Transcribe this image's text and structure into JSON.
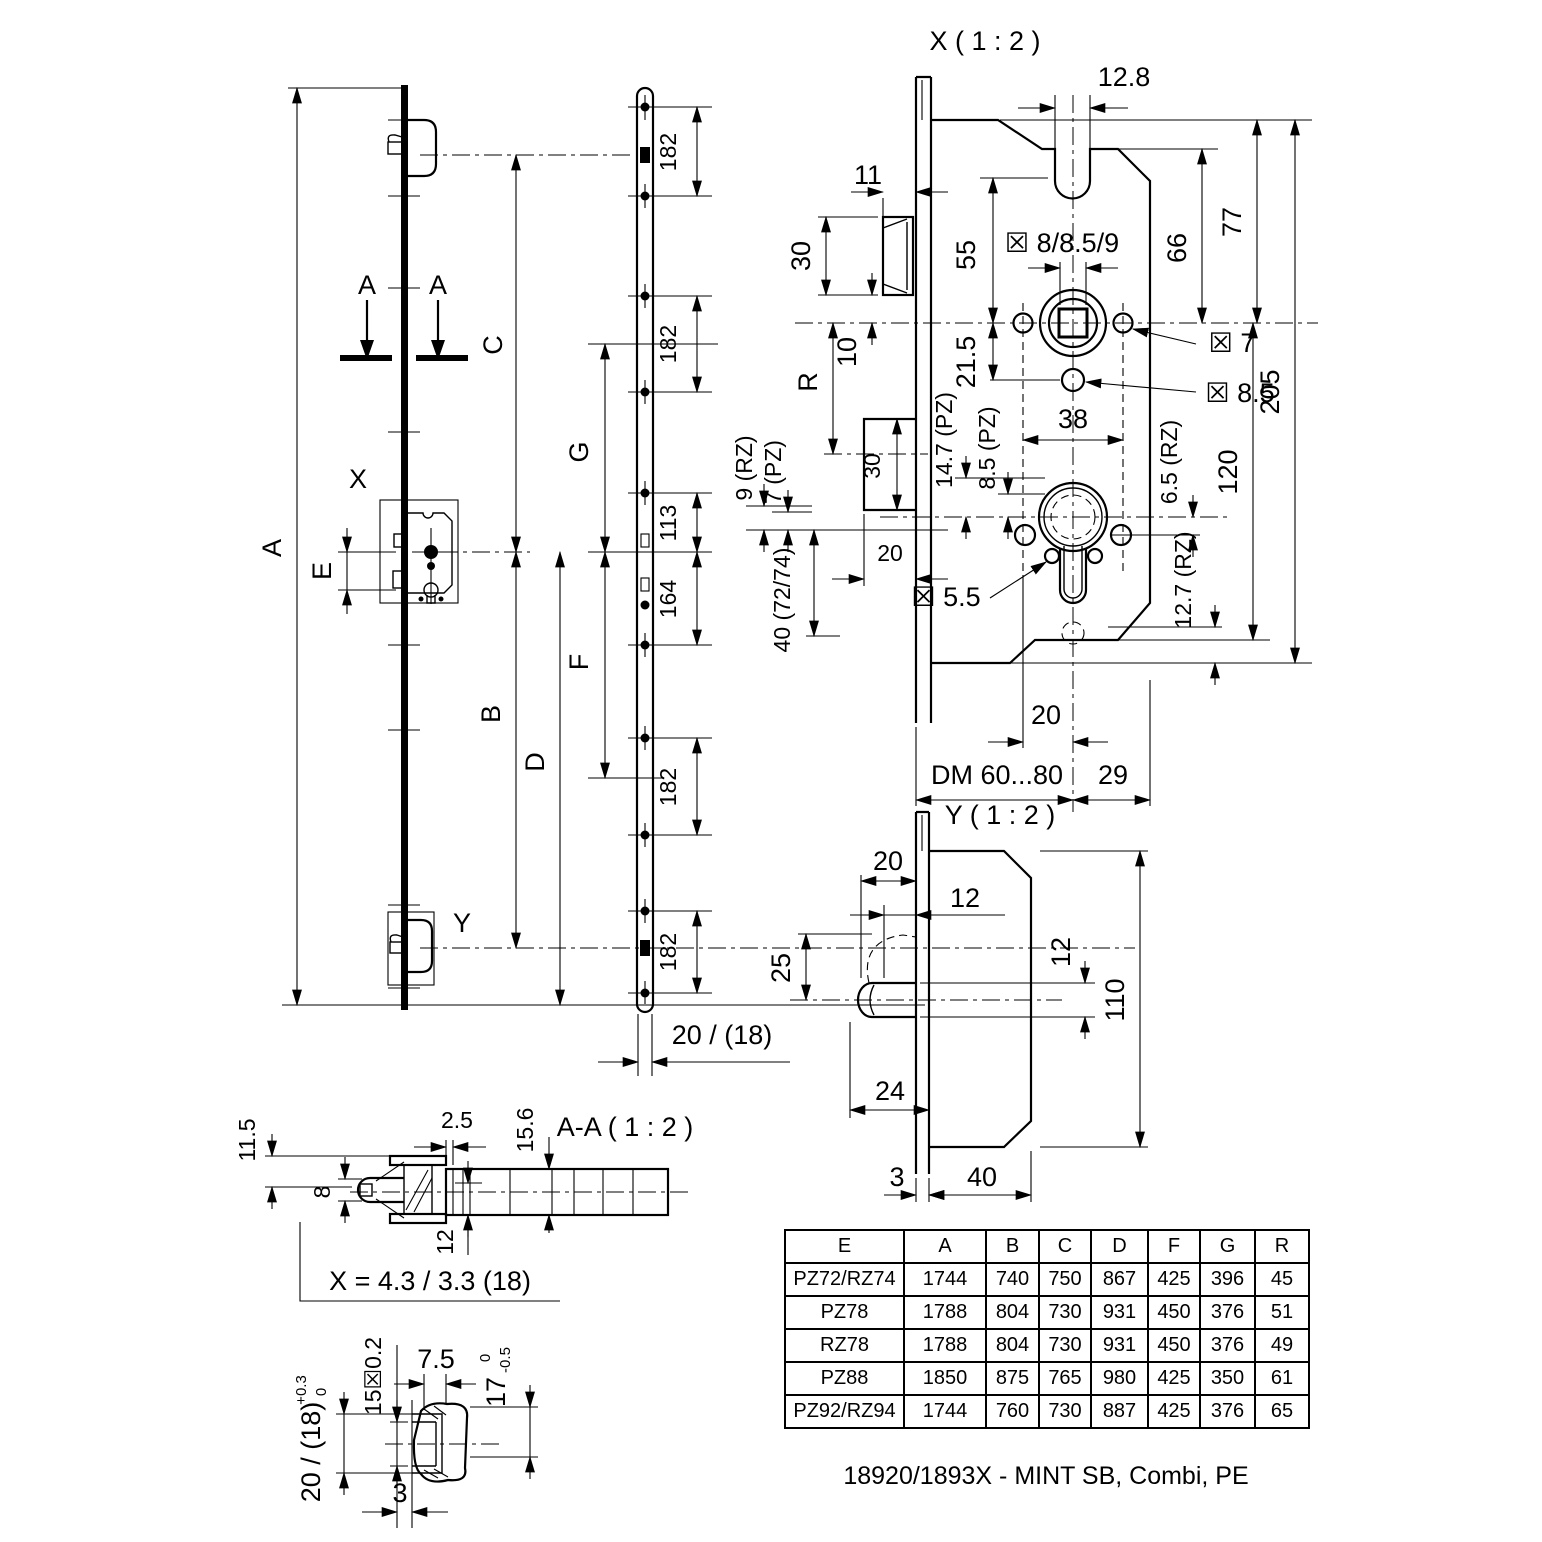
{
  "front": {
    "dim_A": "A",
    "dim_B": "B",
    "dim_C": "C",
    "dim_D": "D",
    "dim_E": "E",
    "dim_F": "F",
    "dim_G": "G",
    "detail_X": "X",
    "detail_Y": "Y",
    "section_arrow_left": "A",
    "section_arrow_right": "A"
  },
  "strip": {
    "dim_182_1": "182",
    "dim_182_2": "182",
    "dim_113": "113",
    "dim_164": "164",
    "dim_182_3": "182",
    "dim_182_4": "182",
    "dim_width": "20 / (18)"
  },
  "xview": {
    "title": "X ( 1 : 2 )",
    "dim_12_8": "12.8",
    "dim_11": "11",
    "dim_30_top": "30",
    "dim_10": "10",
    "dim_R": "R",
    "dim_55": "55",
    "dim_square": "☒ 8/8.5/9",
    "dim_66": "66",
    "dim_77": "77",
    "dim_205": "205",
    "dim_21_5": "21.5",
    "dim_38": "38",
    "dia_7": "☒ 7",
    "dia_8_5": "☒ 8.5",
    "dim_9_rz": "9 (RZ)",
    "dim_7_pz": "7 (PZ)",
    "dim_14_7": "14.7 (PZ)",
    "dim_8_5_pz": "8.5 (PZ)",
    "dim_30_box": "30",
    "dim_20_box": "20",
    "dim_40": "40 (72/74)",
    "dia_5_5": "☒ 5.5",
    "dim_6_5": "6.5 (RZ)",
    "dim_120": "120",
    "dim_12_7": "12.7 (RZ)",
    "dim_20_cyl": "20",
    "dim_dm": "DM 60...80",
    "dim_29": "29"
  },
  "yview": {
    "title": "Y ( 1 : 2 )",
    "dim_20": "20",
    "dim_12_top": "12",
    "dim_25": "25",
    "dim_12_bolt": "12",
    "dim_110": "110",
    "dim_24": "24",
    "dim_3": "3",
    "dim_40": "40"
  },
  "aa": {
    "title": "A-A ( 1 : 2 )",
    "dim_11_5": "11.5",
    "dim_8": "8",
    "dim_2_5": "2.5",
    "dim_15_6": "15.6",
    "dim_12": "12",
    "callout_x": "X = 4.3 / 3.3 (18)"
  },
  "detail": {
    "dim_20_18": "20 / (18)",
    "tol_top": "+0.3",
    "tol_bot": "0",
    "dim_15": "15☒0.2",
    "dim_7_5": "7.5",
    "dim_17": "17",
    "tol17_top": "0",
    "tol17_bot": "-0.5",
    "dim_3": "3"
  },
  "table": {
    "headers": [
      "E",
      "A",
      "B",
      "C",
      "D",
      "F",
      "G",
      "R"
    ],
    "rows": [
      [
        "PZ72/RZ74",
        "1744",
        "740",
        "750",
        "867",
        "425",
        "396",
        "45"
      ],
      [
        "PZ78",
        "1788",
        "804",
        "730",
        "931",
        "450",
        "376",
        "51"
      ],
      [
        "RZ78",
        "1788",
        "804",
        "730",
        "931",
        "450",
        "376",
        "49"
      ],
      [
        "PZ88",
        "1850",
        "875",
        "765",
        "980",
        "425",
        "350",
        "61"
      ],
      [
        "PZ92/RZ94",
        "1744",
        "760",
        "730",
        "887",
        "425",
        "376",
        "65"
      ]
    ]
  },
  "caption": "18920/1893X - MINT SB, Combi, PE"
}
